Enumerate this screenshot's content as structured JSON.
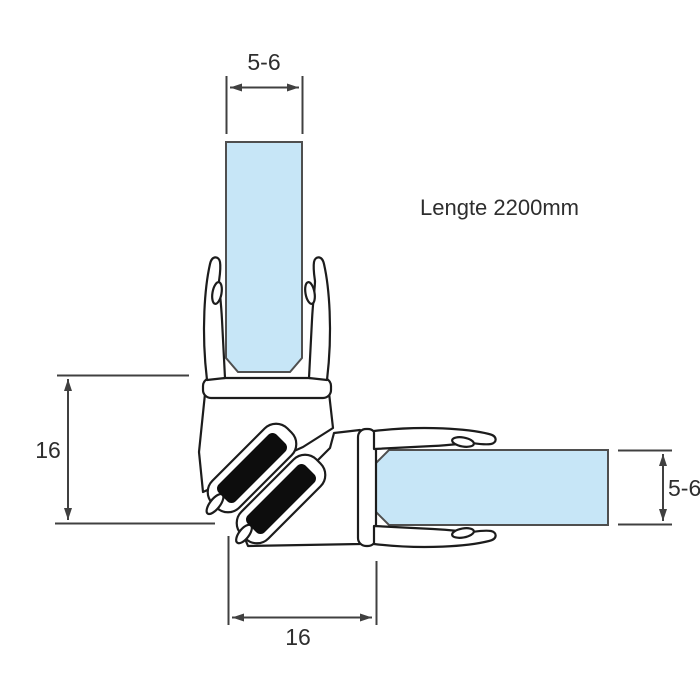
{
  "diagram": {
    "note": "Lengte 2200mm",
    "dimensions": {
      "top_glass_thickness": "5-6",
      "left_profile_height": "16",
      "right_glass_thickness": "5-6",
      "bottom_profile_width": "16"
    },
    "colors": {
      "glass": "#c7e6f7",
      "magnet": "#0d0d0d",
      "profile_outline": "#1c1c1c",
      "dimension": "#404040",
      "background": "#ffffff"
    }
  }
}
